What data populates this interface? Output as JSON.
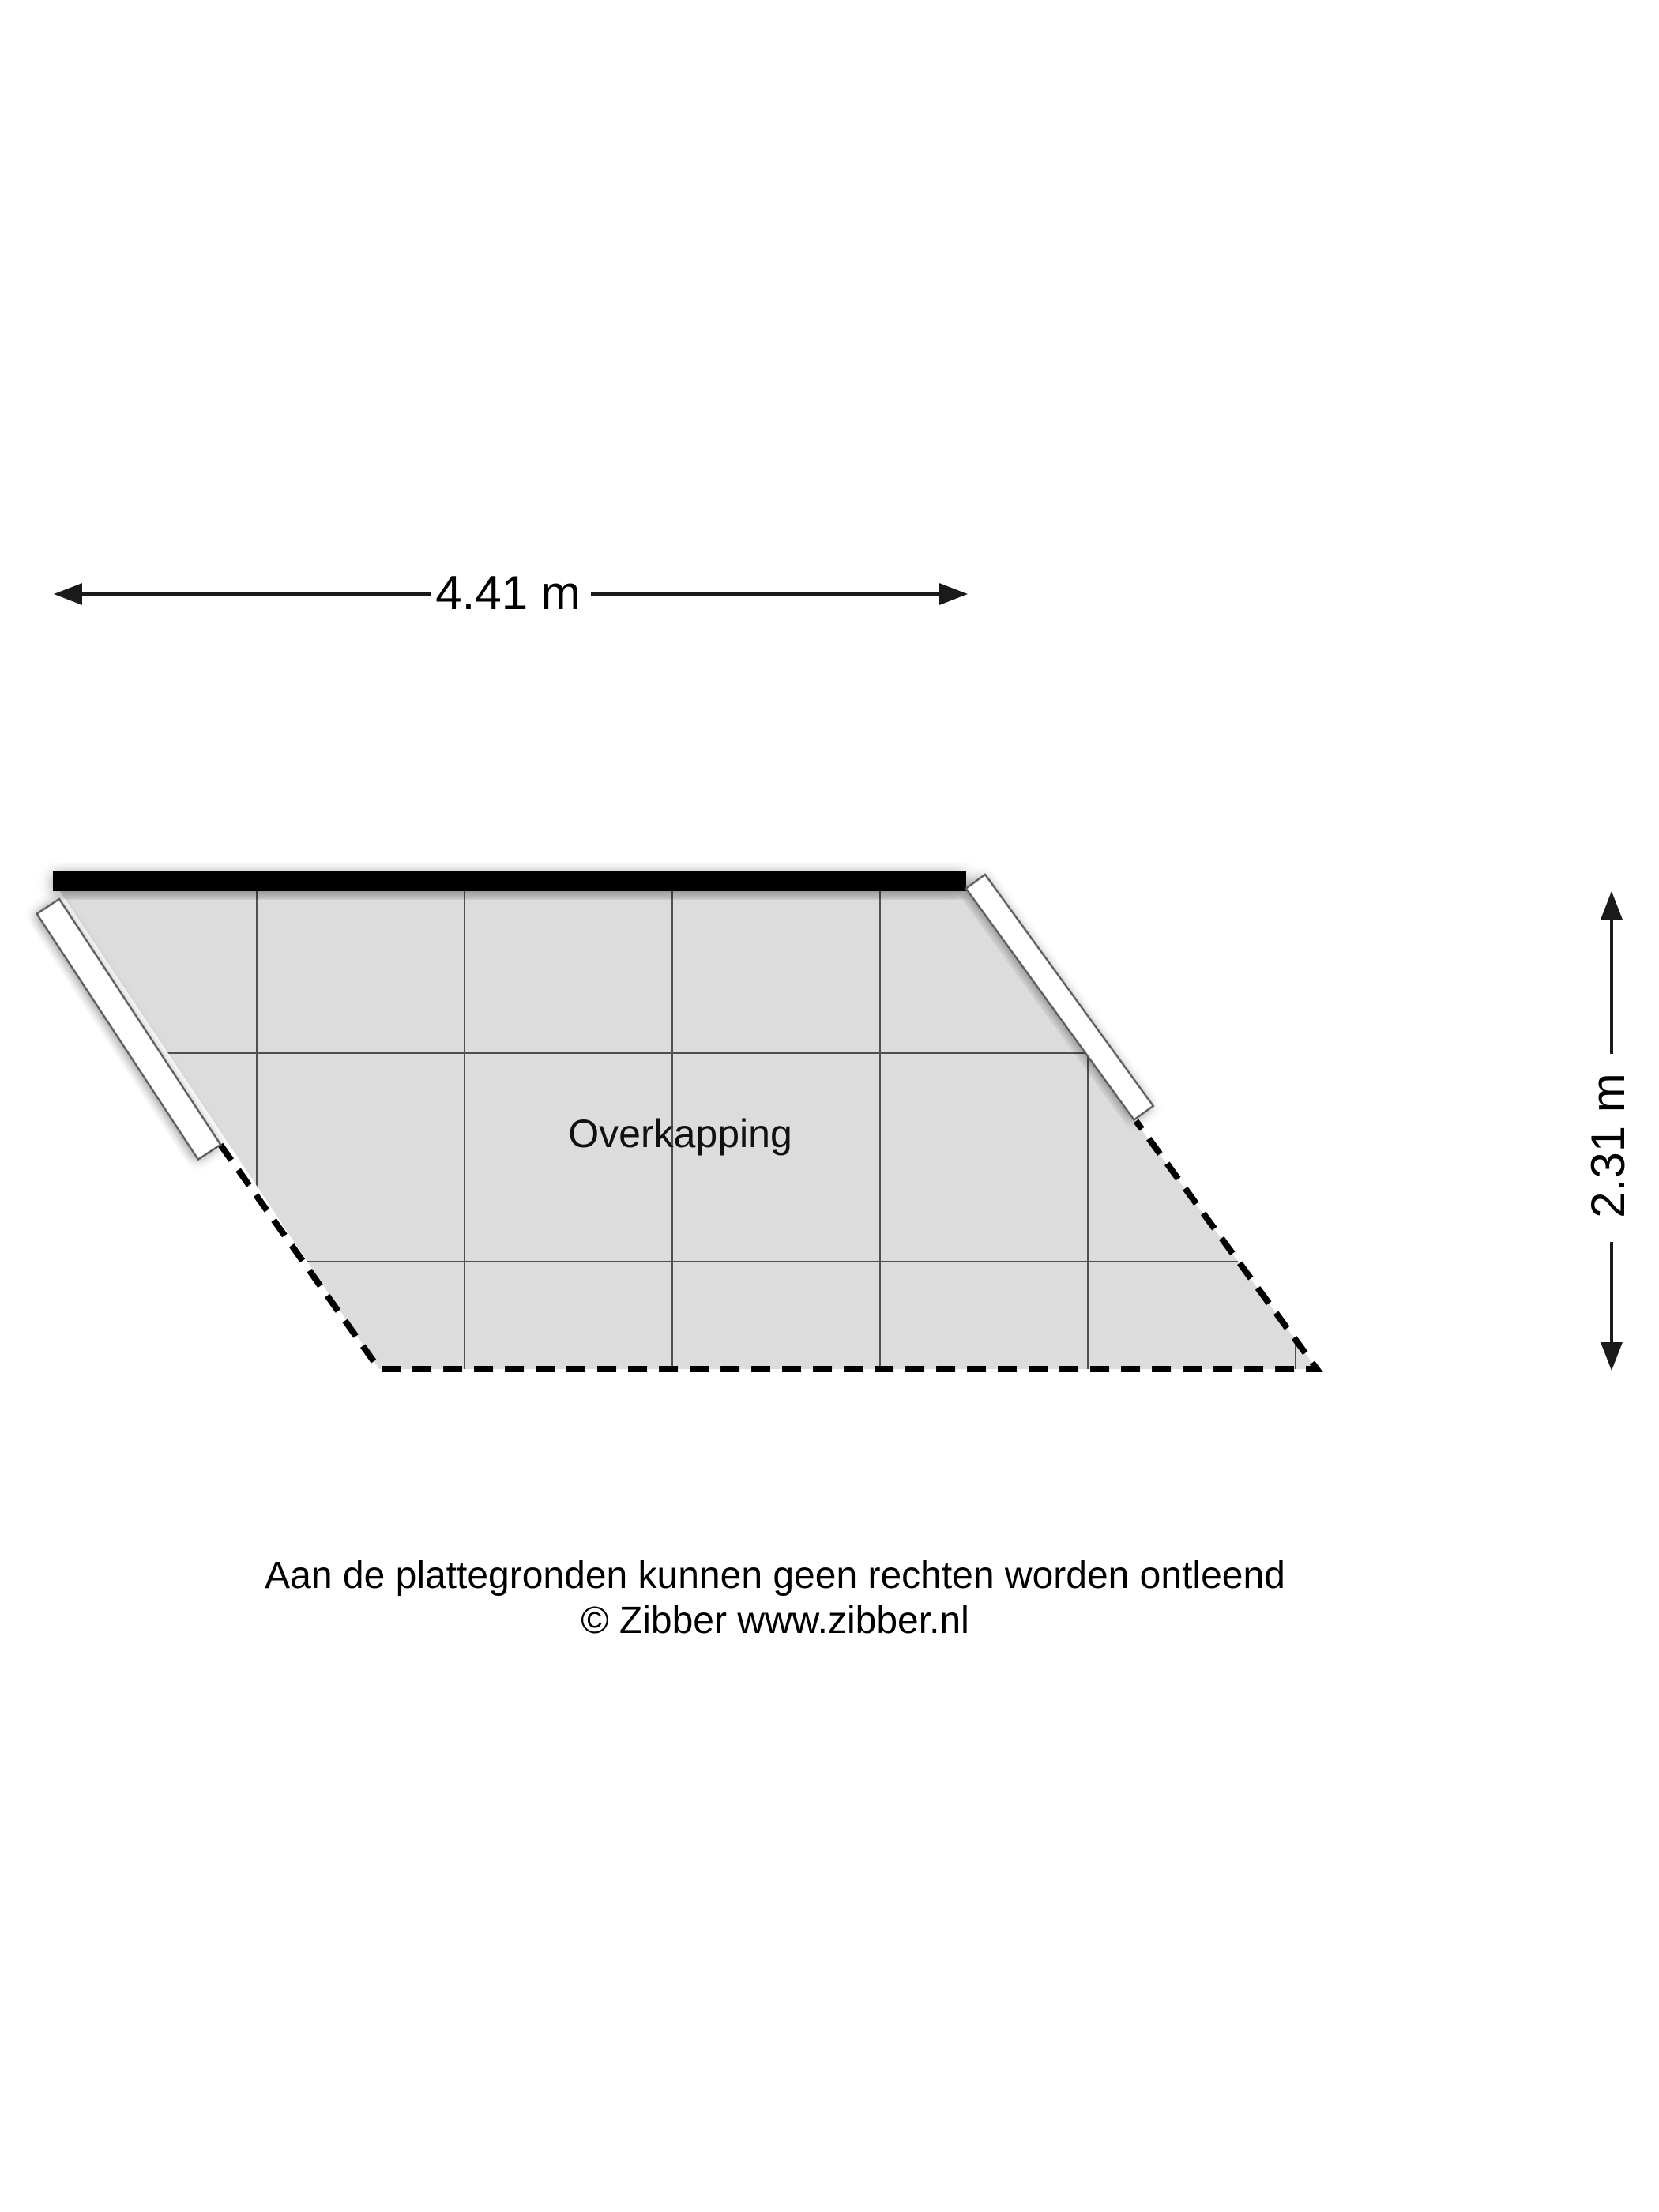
{
  "plan": {
    "room_label": "Overkapping",
    "width_dimension": "4.41 m",
    "height_dimension": "2.31 m"
  },
  "footer": {
    "disclaimer": "Aan de plattegronden kunnen geen rechten worden ontleend",
    "copyright": "© Zibber www.zibber.nl"
  },
  "colors": {
    "floor_fill": "#dcdcdc",
    "grid_line": "#4f4f4f",
    "solid_wall": "#000000",
    "dash_line": "#000000",
    "dimension": "#1a1a1a"
  }
}
